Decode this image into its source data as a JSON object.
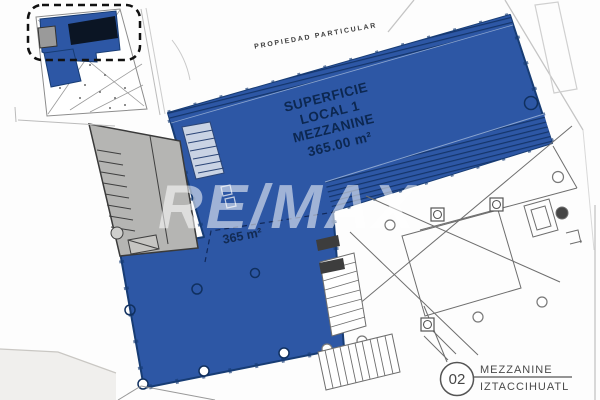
{
  "labels": {
    "property_boundary": "PROPIEDAD PARTICULAR",
    "area_title_lines": [
      "SUPERFICIE",
      "LOCAL 1",
      "MEZZANINE",
      "365.00 m²"
    ],
    "area_size": "365 m²"
  },
  "watermark": {
    "text": "RE/MAX"
  },
  "title_block": {
    "number": "02",
    "level": "MEZZANINE",
    "project": "IZTACCIHUATL"
  },
  "colors": {
    "highlight_blue": "#2d57a5",
    "highlight_blue_dark": "#173c74",
    "hatch_navy": "#14356b",
    "stair_gray": "#b5b5b3",
    "plan_line_gray": "#6e6e6e",
    "street_gray": "#c4c4c4",
    "label_gray": "#4a4a4a",
    "background": "#fdfdfd"
  }
}
